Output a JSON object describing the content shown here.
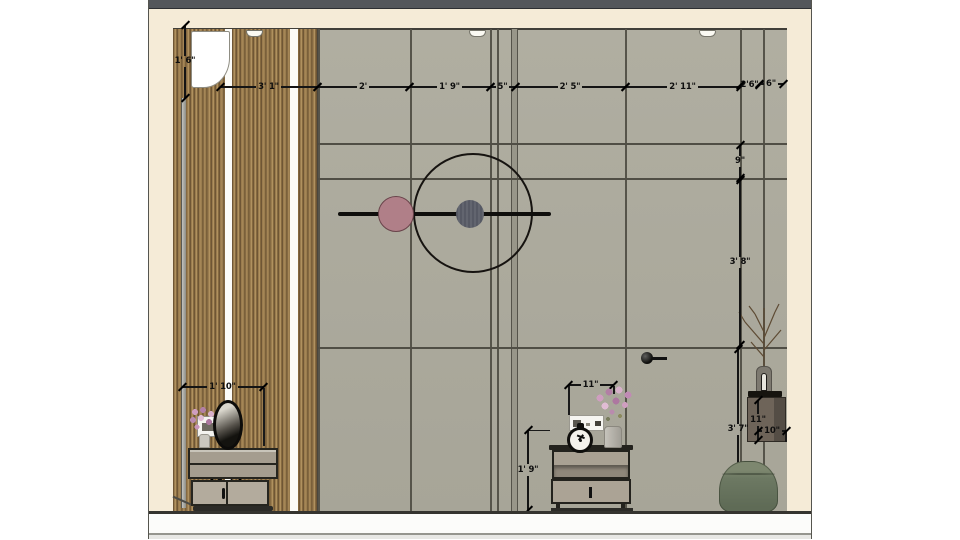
{
  "title": "interior-wall-elevation",
  "colors": {
    "outer_background": "#ffffff",
    "top_band": "#54575b",
    "ceiling_border_cream": "#f5ebd7",
    "wall_gray": "#aaa89b",
    "wood_slat": "#9a7c4e",
    "dimension_text": "#0e0e0e",
    "art_pink_disc": "#b07f88",
    "art_dark_disc": "#5c5f6a",
    "pouf_green": "#6d7963",
    "shelf_brown": "#6e6459",
    "floor_white": "#fcfcfa"
  },
  "dims": {
    "t1": {
      "label": "3' 1\""
    },
    "t2": {
      "label": "2'"
    },
    "t3": {
      "label": "1' 9\""
    },
    "t4": {
      "label": "5\""
    },
    "t5": {
      "label": "2' 5\""
    },
    "t6": {
      "label": "2' 11\""
    },
    "t7": {
      "label": "2'6\""
    },
    "t8": {
      "label": "6\""
    },
    "l1": {
      "label": "1' 6\""
    },
    "r1": {
      "label": "9\""
    },
    "r2": {
      "label": "3' 8\""
    },
    "r3": {
      "label": "3' 7\""
    },
    "dr1": {
      "label": "1' 10\""
    },
    "dr2": {
      "label": "1' 4\""
    },
    "n1": {
      "label": "11\""
    },
    "n2": {
      "label": "1' 9\""
    },
    "s1": {
      "label": "11\""
    },
    "s2": {
      "label": "10\""
    }
  }
}
